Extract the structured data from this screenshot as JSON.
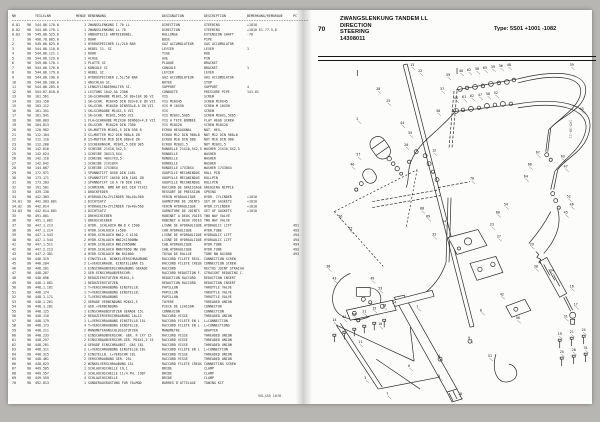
{
  "header": {
    "page_no": "70",
    "title_line1": "ZWANGSLENKUNG TANDEM LL",
    "title_line2": "DIRECTION",
    "title_line3": "STEERING",
    "title_line4": "14308011",
    "type_label": "Type: 5S01   +1001 -1082"
  },
  "footer_text": "VGL/A9 1076",
  "parts_table": {
    "columns": [
      "NR",
      "",
      "TEILE+NR",
      "MENGE",
      "BENENNUNG",
      "DESIGNATION",
      "DESCRIPTION",
      "BEMERKUNG/REMARQUE",
      "PC"
    ],
    "rows": [
      [
        "0.01",
        "90",
        "544.06.170.0",
        "1",
        "ZWANGSLENKUNG I 70 LL",
        "DIRECTION",
        "STEERING",
        "+1010",
        ""
      ],
      [
        "0.02",
        "90",
        "544.06.170.1",
        "1",
        "ZWANGSLENKUNG LL 70",
        "DIRECTION",
        "STEERING",
        "+1010 E1-77.5.8",
        ""
      ],
      [
        "0.03",
        "90",
        "549.08.525.0",
        "1",
        "ANBAUTEILE ANTRIEBSWEL.",
        "RALLONGE",
        "EXTENSION SHAFT",
        "-70",
        ""
      ],
      [
        "1",
        "90",
        "490.70.005.0",
        "1",
        "ROHR",
        "BUSE",
        "PIPE",
        "",
        ""
      ],
      [
        "2",
        "90",
        "549.06.025.0",
        "1",
        "HYDROSPEICHER 1L/210 BAR",
        "GAZ ACCUMULATEUR",
        "GAS ACCUMULATOR",
        "",
        ""
      ],
      [
        "3",
        "90",
        "544.06.110.0",
        "1",
        "HEBEL 11. SI",
        "LEVIER",
        "LEVER",
        "1",
        ""
      ],
      [
        "4",
        "90",
        "544.06.121.1",
        "1",
        "ROHR",
        "TIGE",
        "ROD",
        "",
        ""
      ],
      [
        "5",
        "90",
        "544.06.129.0",
        "1",
        "ACHSE",
        "AXE",
        "PIN",
        "",
        ""
      ],
      [
        "6",
        "90",
        "549.06.170.1",
        "1",
        "PLATTE SI",
        "PLAQUE",
        "BRACKET",
        "",
        ""
      ],
      [
        "7",
        "90",
        "544.06.176.0",
        "1",
        "KONSOLE SI",
        "CONSOLE",
        "BRACKET",
        "1",
        ""
      ],
      [
        "8",
        "90",
        "544.06.179.0",
        "1",
        "HEBEL SI",
        "LEVIER",
        "LEVER",
        "",
        ""
      ],
      [
        "9",
        "90",
        "544.06.190.0",
        "1",
        "HYDROSPEICHER 2,5L/50 BAR",
        "GAZ ACCUMULATEUR",
        "GAS ACCUMULATOR",
        "",
        ""
      ],
      [
        "10",
        "90",
        "544.06.200.0",
        "1",
        "ANSCHLAG SI.",
        "BUTEE",
        "STOP",
        "",
        ""
      ],
      [
        "11",
        "90",
        "544.06.205.0",
        "1",
        "LENKZYLINDERHALTER SI.",
        "SUPPORT",
        "SUPPORT",
        "4",
        ""
      ],
      [
        "12",
        "90",
        "554.07.018.0",
        "1",
        "LEITUNG 1042.5A 230N",
        "CONDUITE",
        "PRESSURE PIPE",
        "141.61",
        ""
      ],
      [
        "13",
        "90",
        "101.561",
        "1",
        "SK+SCHRAUBE M10X1,5X 80+10X 90 VZ",
        "VIS",
        "SCREW",
        "",
        ""
      ],
      [
        "14",
        "90",
        "103.158",
        "1",
        "SK+SCHR. M16X45 DIN 933+8.8 ZN VZ1",
        "VIS M16X45",
        "SCREW M16X45",
        "",
        ""
      ],
      [
        "15",
        "90",
        "103.112",
        "1",
        "SK+SCHR. M16X50 DIN933+8.8 ZN VZ1",
        "VIS M 16X50",
        "SCREW M 16X50",
        "",
        ""
      ],
      [
        "16",
        "90",
        "101.351",
        "1",
        "SK+SCHRAUBE M14X1,5 VZ1",
        "VIS",
        "SCREW",
        "",
        ""
      ],
      [
        "17",
        "90",
        "101.941",
        "1",
        "SK+SCHR. M20X1,5X65 VZ1",
        "VIS M20X1,5X65",
        "SCREW M20X1,5X65",
        "",
        ""
      ],
      [
        "18",
        "90",
        "108.003",
        "1",
        "FLA+SCHRAUBE M12X30 DIN603+4.8 VZ1",
        "VIS A TETE BOMBEE",
        "FLAT HEAD SCREW",
        "",
        ""
      ],
      [
        "19",
        "90",
        "104.813",
        "4",
        "SK+SCHR. M10X20 DIN 7380",
        "VIS M10X20",
        "SCREW M10X20",
        "",
        ""
      ],
      [
        "20",
        "90",
        "120.982",
        "1",
        "SK+MUTTER M10X1,5 DIN 936 8",
        "ECROU HEXAGONAL",
        "NUT, HEX.",
        "",
        ""
      ],
      [
        "21",
        "90",
        "112.104",
        "3",
        "SI+MUTTER M12 DIN 980+8 ZN",
        "ECROU M12 DIN 980+8",
        "NUT M12 DIN 980+8",
        "",
        ""
      ],
      [
        "22",
        "90",
        "112.110",
        "8",
        "SI+MUTTER M16 DIN 980+8 ZN",
        "ECROU M16 DIN 980",
        "NUT M16 DIN 980",
        "",
        ""
      ],
      [
        "23",
        "90",
        "112.200",
        "3",
        "SICHERUNGSM. M20X1,5 DIN 985",
        "ECROU M20X1,5",
        "NUT M20X1,5",
        "",
        ""
      ],
      [
        "24",
        "90",
        "142.616",
        "2",
        "SCHEIBE 21X10,5X2,5",
        "RONDELLE 21X10,5X2,5",
        "WASHER 21X10,5X2,5",
        "",
        ""
      ],
      [
        "25",
        "90",
        "142.624",
        "1",
        "SCHEIBE 36X13,5X4",
        "RONDELLE",
        "WASHER",
        "",
        ""
      ],
      [
        "26",
        "90",
        "142.116",
        "2",
        "SCHEIBE 40X17X3,5",
        "RONDELLE",
        "WASHER",
        "",
        ""
      ],
      [
        "27",
        "90",
        "142.642",
        "1",
        "SCHEIBE 21X10X4",
        "RONDELLE",
        "WASHER",
        "",
        ""
      ],
      [
        "28",
        "90",
        "144.807",
        "2",
        "SCHEIBE 17X30X4",
        "RONDELLE 17X30X4",
        "WASHER 17X30X4",
        "",
        ""
      ],
      [
        "29",
        "90",
        "172.971",
        "1",
        "SPANNSTIFT 8X50 DIN 1481",
        "GOUPILLE MECANINDUS",
        "ROLL PIN",
        "",
        ""
      ],
      [
        "30",
        "90",
        "173.171",
        "1",
        "SPANNSTIFT 10X50 DIN 1481 ZN",
        "GOUPILLE MECANINDUS",
        "ROLLPIN",
        "",
        ""
      ],
      [
        "31",
        "90",
        "173.203",
        "1",
        "SPANNSTIFT 10 A 70 DIN 1481",
        "GOUPILLE MECANINDUS",
        "ROLLPIN",
        "",
        ""
      ],
      [
        "32",
        "90",
        "191.501",
        "1",
        "SCHMIERN. BM8 AM 8X1 DIN 71412",
        "RACCORD DE GRAISSAGE",
        "GREASING NIPPLE",
        "",
        ""
      ],
      [
        "33",
        "90",
        "439.138",
        "1",
        "DRUCKFEDER",
        "RESSORT DE PRESSION",
        "SPRING",
        "",
        ""
      ],
      [
        "34",
        "90",
        "442.303",
        "1",
        "HYDRAULIK+ZYLINDER 90+40+560",
        "VERIN HYDRAULIQUE",
        "HYDR. CYLINDER",
        "+1010",
        ""
      ],
      [
        "34.01",
        "90",
        "442.303.001",
        "1",
        "DICHTSATZ",
        "GARNITURE DE JOINTS",
        "SET OF GASKETS",
        "+1010",
        ""
      ],
      [
        "34.02",
        "90",
        "442.614",
        "1",
        "HYDRAULIK+ZYLINDER 70+40+560",
        "VERIN HYDRAULIQUE",
        "HYDR.CYLINDER",
        "+1010",
        ""
      ],
      [
        "34.03",
        "90",
        "442.614.001",
        "1",
        "DICHTSATZ",
        "GARNITURE DE JOINTS",
        "SET OF GASKETS",
        "+1010",
        ""
      ],
      [
        "35",
        "90",
        "491.001",
        "1",
        "DREHSCHIEBER",
        "ROBINET A DEUX VOIES",
        "TWO WAY VALVE",
        "",
        ""
      ],
      [
        "36",
        "90",
        "491.1.001",
        "1",
        "DREHSCHIEBER",
        "ROBINET A DEUX VOIES",
        "TWO WAY VALVE",
        "",
        ""
      ],
      [
        "37",
        "90",
        "447.1.213",
        "1",
        "HYDR. SCHLAUCH NW 8 X 1500",
        "LIGNE DE HYDRAULIQUE",
        "HYDRAULIC LIFT",
        "",
        "491"
      ],
      [
        "38",
        "90",
        "447.1.214",
        "1",
        "HYDR.SCHLAUCH L+500",
        "CAB.HYDRAULIQUE",
        "HYDR.TUBE",
        "",
        "493"
      ],
      [
        "39",
        "90",
        "447.1.543",
        "4",
        "HYDR.SCHLAUCH NW12 X 4130",
        "LIGNE DE HYDRAULIQUE",
        "HYDRAULIC LIFT",
        "",
        "494"
      ],
      [
        "40",
        "90",
        "447.1.544",
        "2",
        "HYDR.SCHLAUCH NW12X1500NW",
        "LIGNE DE HYDRAULIQUE",
        "HYDRAULIC LIFT",
        "",
        "494"
      ],
      [
        "41",
        "90",
        "447.1.511",
        "2",
        "HYDR.SCHLAUCH NW12X650NW",
        "CAB.HYDRAULIQUE",
        "HYDR.TUBE",
        "",
        "494"
      ],
      [
        "42",
        "90",
        "447.2.213",
        "2",
        "HYDR.SCHLAUCH NW67X650 NW 200",
        "CAB.HYDRAULIQUE",
        "HYDR.TUBE",
        "",
        "493"
      ],
      [
        "43",
        "90",
        "447.2.381",
        "4",
        "HYDR.SCHLAUCH NW 8X1000",
        "TUYAU DE RALLGE",
        "TUBE NW 8X1000",
        "",
        "493"
      ],
      [
        "44",
        "90",
        "446.319",
        "1",
        "EINSTELLB. WINKELVERSCHRAUBUNG",
        "RACCORD FILETE REGL.",
        "CONNECTION SCREW",
        "",
        ""
      ],
      [
        "45",
        "90",
        "446.204",
        "2",
        "L+VERSCHRAUB. EINSTELLBAR IS",
        "RACCORD FILETE CREUX",
        "CONNECTION SCREW",
        "",
        ""
      ],
      [
        "46",
        "90",
        "448.201",
        "1",
        "EINSCHRAUBVERSCHRAUBUNG GERADE",
        "RACCORD",
        "RECTUS JOINT STRAIGH",
        "",
        ""
      ],
      [
        "47",
        "90",
        "448.207",
        "2",
        "GER.EINSCHRAUBVERSCHR.",
        "RACCORD REDUCTION F.",
        "STRAIGHT REDUCING C.",
        "",
        ""
      ],
      [
        "48",
        "90",
        "448.096",
        "2",
        "REDUZIERSTUTZEN M16X1,5",
        "REDUCTION RACCORD",
        "REDUCTION INSERT",
        "",
        ""
      ],
      [
        "49",
        "90",
        "448.1.081",
        "1",
        "REDUZIERSTUTZEN",
        "REDUCTION RACCORD",
        "REDUCTION INSERT",
        "",
        ""
      ],
      [
        "50",
        "90",
        "448.1.181",
        "1",
        "T+VERSCHRAUBUNG EINSTELLB.",
        "PAPILLON",
        "THROTTLE VALVE",
        "",
        ""
      ],
      [
        "51",
        "90",
        "448.174",
        "1",
        "T+VERSCHRAUBUNG EINSTELLB.",
        "PAPILLON",
        "THROTTLE VALVE",
        "",
        ""
      ],
      [
        "52",
        "90",
        "448.1.171",
        "1",
        "T+VERSCHRAUBUNG",
        "PAPILLON",
        "THROTTLE VALVE",
        "",
        ""
      ],
      [
        "53",
        "90",
        "448.1.261",
        "2",
        "GERADE VERBINDUNG M26X1,5",
        "TUYERE",
        "THREADED UNION",
        "",
        ""
      ],
      [
        "54",
        "90",
        "448.1.281",
        "2",
        "GER.+VERBINDUNG",
        "PIECE DE LIAISON",
        "CONNECTOR",
        "",
        ""
      ],
      [
        "55",
        "90",
        "448.125",
        "1",
        "EINSCHRAUBSTUTZEN GERADE 15L",
        "CONNEXION",
        "CONNECTION",
        "",
        ""
      ],
      [
        "56",
        "90",
        "448.110",
        "2",
        "REDUZIERVERSCHRAUBUNG 18+15",
        "RACCORD VISSE",
        "THREADED UNION",
        "",
        ""
      ],
      [
        "57",
        "90",
        "448.179",
        "1",
        "L+VERSCHRAUBUNG EINSTELLB.15L",
        "RACCORD FILETE EN L",
        "L+CONNECTION",
        "",
        ""
      ],
      [
        "58",
        "90",
        "448.173",
        "4",
        "T+VERSCHRAUBUNG EINSTELLB.",
        "RACCORD FILETE EN L",
        "L+CONNECTIONS",
        "",
        ""
      ],
      [
        "59",
        "90",
        "448.211",
        "2",
        "MANOMETERANSCHLUSSSTUTZEN",
        "MANOMETRE",
        "ADAPTER",
        "",
        ""
      ],
      [
        "60",
        "90",
        "448.233",
        "1",
        "EINSCHRAUBVERSCHR. GER. R 1X7 15",
        "RACCORD VISSE",
        "THREADED UNION",
        "",
        ""
      ],
      [
        "61",
        "90",
        "448.257",
        "2",
        "EINSCHRAUBVERSCHR.GER. M16X1,5 15",
        "RACCORD VISSE",
        "THREADED UNION",
        "",
        ""
      ],
      [
        "62",
        "90",
        "448.261",
        "4",
        "GERADE EINSCHRAUBST. GAS 18L",
        "RACCORD VISSE",
        "THREADED UNION",
        "",
        ""
      ],
      [
        "63",
        "90",
        "448.311",
        "2",
        "L+VERSCHRAUBUNG EINSTELLB.18L",
        "RACCORD FILETE EN L",
        "L+CONNECTION",
        "",
        ""
      ],
      [
        "64",
        "90",
        "448.315",
        "2",
        "EINSTELLB. L+VERSCHR 18L",
        "RACCORD VISSE",
        "THREADED UNION",
        "",
        ""
      ],
      [
        "65",
        "90",
        "448.461",
        "2",
        "VERSCHRAUBUNG GER. 25L",
        "RACCORD VISSE",
        "THREADED UNION",
        "",
        ""
      ],
      [
        "66",
        "90",
        "448.623",
        "2",
        "WINKELVERSCHRAUBUNG 15L",
        "RACCORD FILETE CREUX",
        "CONNECTING SCREW",
        "",
        ""
      ],
      [
        "67",
        "90",
        "449.505",
        "1",
        "SCHLAUCHSCHELLE 19,1",
        "BRIDE",
        "CLAMP",
        "",
        ""
      ],
      [
        "68",
        "90",
        "449.557",
        "2",
        "SCHLAUCHSCHELLE 11/4 PH. 1987",
        "BRIDE",
        "CLAMP",
        "",
        ""
      ],
      [
        "69",
        "90",
        "449.559",
        "4",
        "SCHLAUCHSCHELLE",
        "BRIDE",
        "CLAMP",
        "",
        ""
      ],
      [
        "70",
        "90",
        "492.813",
        "1",
        "SONDERAUSRUSTUNG FUR 70+MOD",
        "BARRES D'ATTELAGE",
        "TOWING KIT",
        "",
        ""
      ]
    ]
  },
  "diagram": {
    "drawing_no": "145-38-11",
    "callouts": [
      [
        13,
        90,
        6
      ],
      [
        22,
        98,
        12
      ],
      [
        28,
        56,
        30
      ],
      [
        25,
        66,
        42
      ],
      [
        2,
        36,
        60
      ],
      [
        44,
        80,
        64
      ],
      [
        55,
        88,
        74
      ],
      [
        20,
        84,
        86
      ],
      [
        57,
        36,
        96
      ],
      [
        46,
        30,
        106
      ],
      [
        59,
        126,
        16
      ],
      [
        37,
        120,
        30
      ],
      [
        40,
        139,
        12
      ],
      [
        62,
        147,
        11
      ],
      [
        58,
        155,
        10
      ],
      [
        65,
        163,
        9
      ],
      [
        39,
        171,
        8
      ],
      [
        56,
        179,
        7
      ],
      [
        48,
        187,
        6
      ],
      [
        41,
        134,
        39
      ],
      [
        61,
        142,
        38
      ],
      [
        62,
        150,
        37
      ],
      [
        47,
        158,
        36
      ],
      [
        58,
        166,
        35
      ],
      [
        52,
        174,
        34
      ],
      [
        38,
        116,
        52
      ],
      [
        39,
        250,
        6
      ],
      [
        43,
        260,
        50
      ],
      [
        63,
        241,
        98
      ],
      [
        47,
        244,
        108
      ],
      [
        52,
        247,
        138
      ],
      [
        46,
        250,
        146
      ],
      [
        45,
        244,
        154
      ],
      [
        12,
        112,
        92
      ],
      [
        36,
        18,
        158
      ],
      [
        35,
        28,
        170
      ],
      [
        34,
        122,
        163
      ],
      [
        33,
        112,
        176
      ],
      [
        23,
        170,
        166
      ],
      [
        27,
        177,
        178
      ],
      [
        38,
        6,
        208
      ],
      [
        43,
        12,
        220
      ],
      [
        49,
        50,
        220
      ],
      [
        53,
        58,
        230
      ],
      [
        14,
        12,
        262
      ],
      [
        22,
        22,
        259
      ],
      [
        26,
        32,
        256
      ],
      [
        21,
        42,
        253
      ],
      [
        15,
        52,
        250
      ],
      [
        19,
        62,
        247
      ],
      [
        24,
        72,
        244
      ],
      [
        1,
        96,
        248
      ],
      [
        10,
        58,
        266
      ],
      [
        11,
        38,
        284
      ],
      [
        6,
        88,
        308
      ],
      [
        5,
        118,
        318
      ],
      [
        18,
        138,
        336
      ],
      [
        7,
        66,
        336
      ],
      [
        3,
        44,
        320
      ],
      [
        29,
        210,
        186
      ],
      [
        30,
        214,
        208
      ],
      [
        34,
        230,
        212
      ],
      [
        16,
        250,
        228
      ],
      [
        17,
        254,
        246
      ],
      [
        31,
        244,
        258
      ],
      [
        42,
        180,
        236
      ],
      [
        50,
        196,
        260
      ],
      [
        51,
        168,
        298
      ],
      [
        19,
        238,
        276
      ],
      [
        21,
        250,
        274
      ],
      [
        24,
        262,
        272
      ],
      [
        25,
        240,
        294
      ],
      [
        28,
        252,
        292
      ],
      [
        31,
        264,
        290
      ],
      [
        70,
        150,
        120
      ],
      [
        64,
        204,
        118
      ],
      [
        66,
        208,
        106
      ],
      [
        67,
        216,
        94
      ],
      [
        54,
        184,
        146
      ],
      [
        60,
        176,
        154
      ],
      [
        9,
        148,
        280
      ],
      [
        4,
        118,
        298
      ],
      [
        8,
        160,
        252
      ],
      [
        68,
        100,
        150
      ],
      [
        69,
        106,
        158
      ]
    ]
  }
}
